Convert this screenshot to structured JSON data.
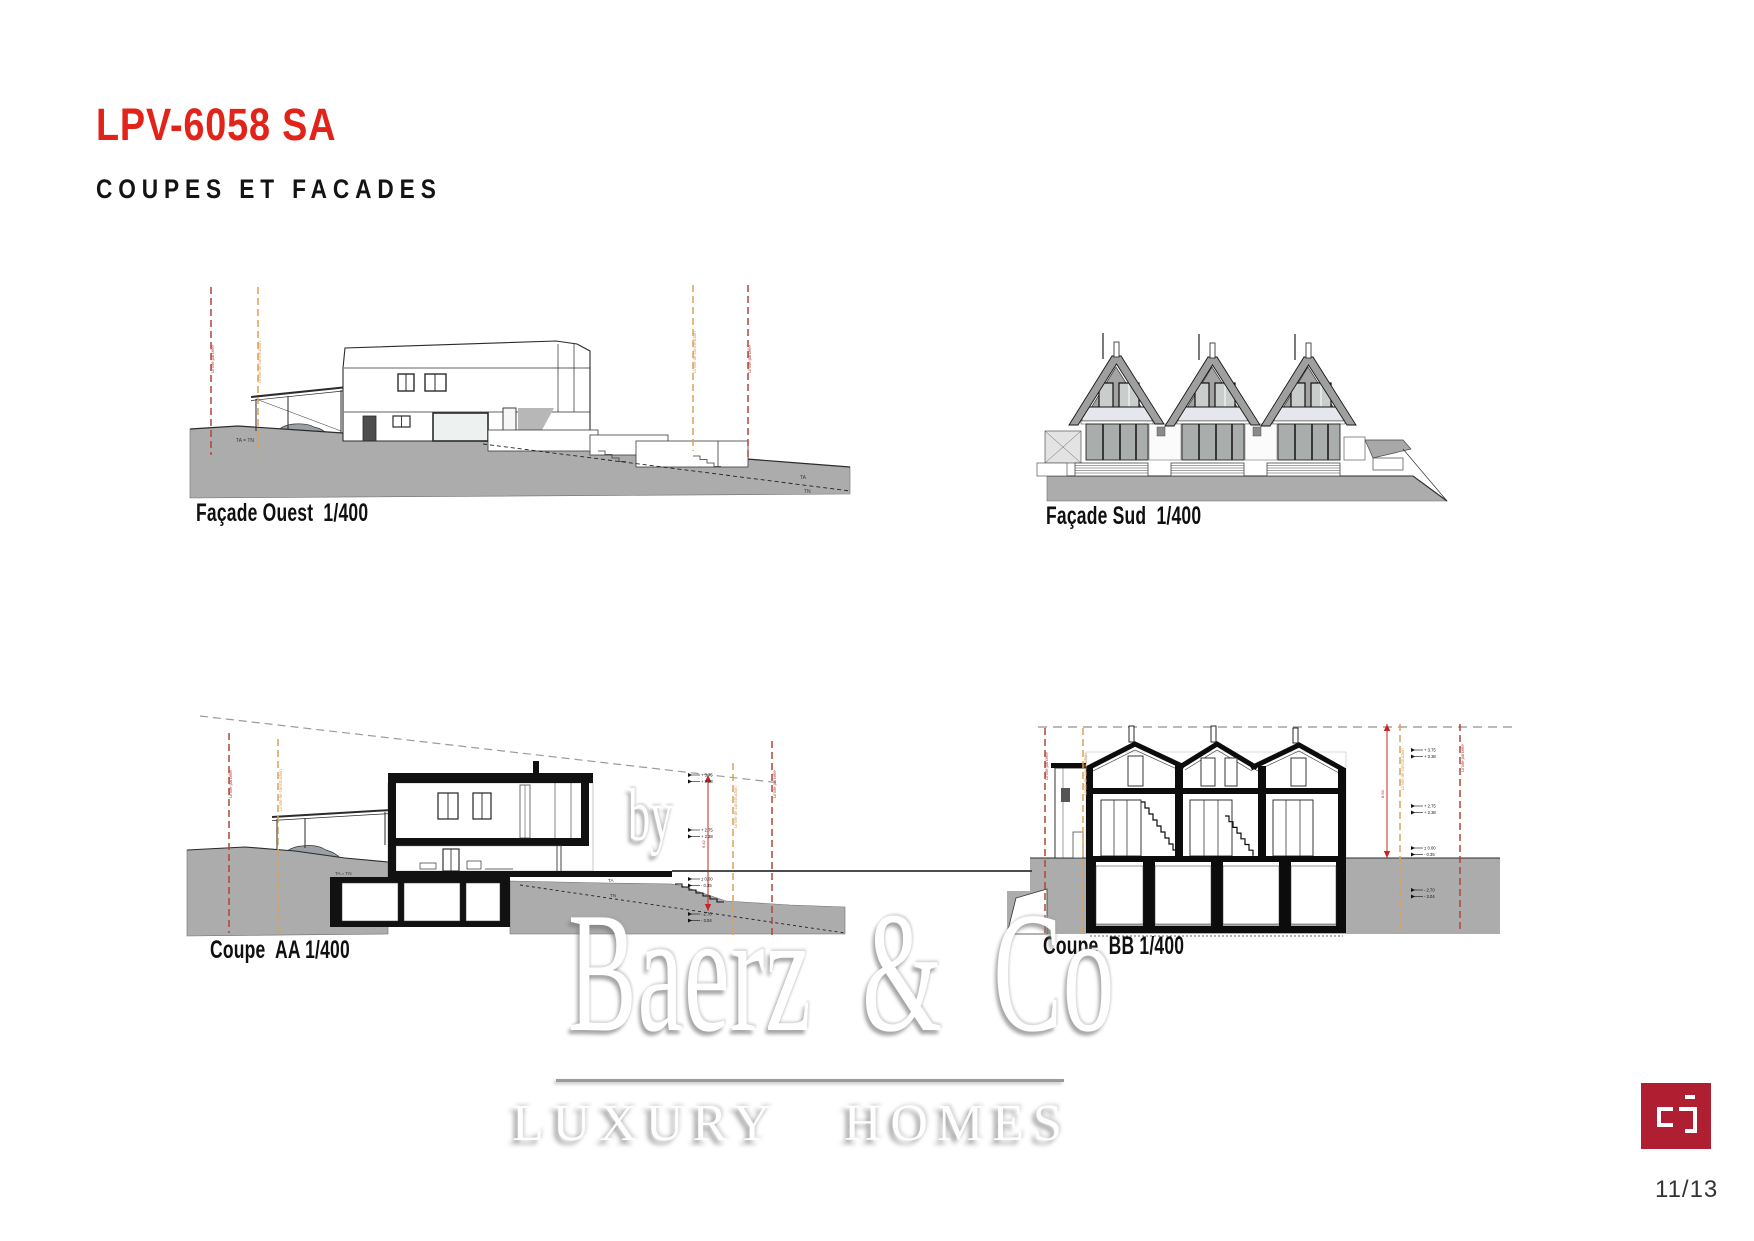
{
  "header": {
    "title": "LPV-6058 SA",
    "subtitle": "COUPES ET FACADES"
  },
  "figures": {
    "facade_ouest": {
      "caption": "Façade Ouest  1/400",
      "labels": {
        "ta_tn": "TA = TN",
        "ta": "TA",
        "tn": "TN"
      },
      "limits": {
        "parcel": "Limite parcelle",
        "construction": "Limite de construction"
      }
    },
    "facade_sud": {
      "caption": "Façade Sud  1/400"
    },
    "coupe_aa": {
      "caption": "Coupe  AA 1/400",
      "labels": {
        "ta_tn": "TA = TN",
        "ta": "TA",
        "tn": "TN"
      },
      "limits": {
        "parcel": "Limite parcelle",
        "construction": "Limite de construction"
      },
      "height_label": "6.42",
      "markers": [
        [
          "+ 3.75",
          "+ 3.38"
        ],
        [
          "+ 2.75",
          "+ 2.38"
        ],
        [
          "± 0.00",
          "- 0.35"
        ],
        [
          "- 2.70",
          "- 3.04"
        ]
      ]
    },
    "coupe_bb": {
      "caption": "Coupe  BB 1/400",
      "limits": {
        "parcel": "Limite parcelle",
        "construction": "Limite de construction"
      },
      "height_label": "8.64",
      "markers": [
        [
          "+ 3.75",
          "+ 3.38"
        ],
        [
          "+ 2.75",
          "+ 2.38"
        ],
        [
          "± 0.00",
          "- 0.35"
        ],
        [
          "- 2.70",
          "- 3.04"
        ]
      ]
    }
  },
  "watermark": {
    "prefix": "by",
    "name": "Baerz & Co",
    "tagline": "LUXURY HOMES"
  },
  "footer": {
    "page_number": "11/13"
  },
  "colors": {
    "title_red": "#E2231A",
    "logo_red": "#B01E32",
    "terrain_gray": "#ACACAC",
    "limit_parcel_red": "#B0453C",
    "limit_construction_orange": "#D9A05B",
    "measure_red": "#CC2222"
  }
}
